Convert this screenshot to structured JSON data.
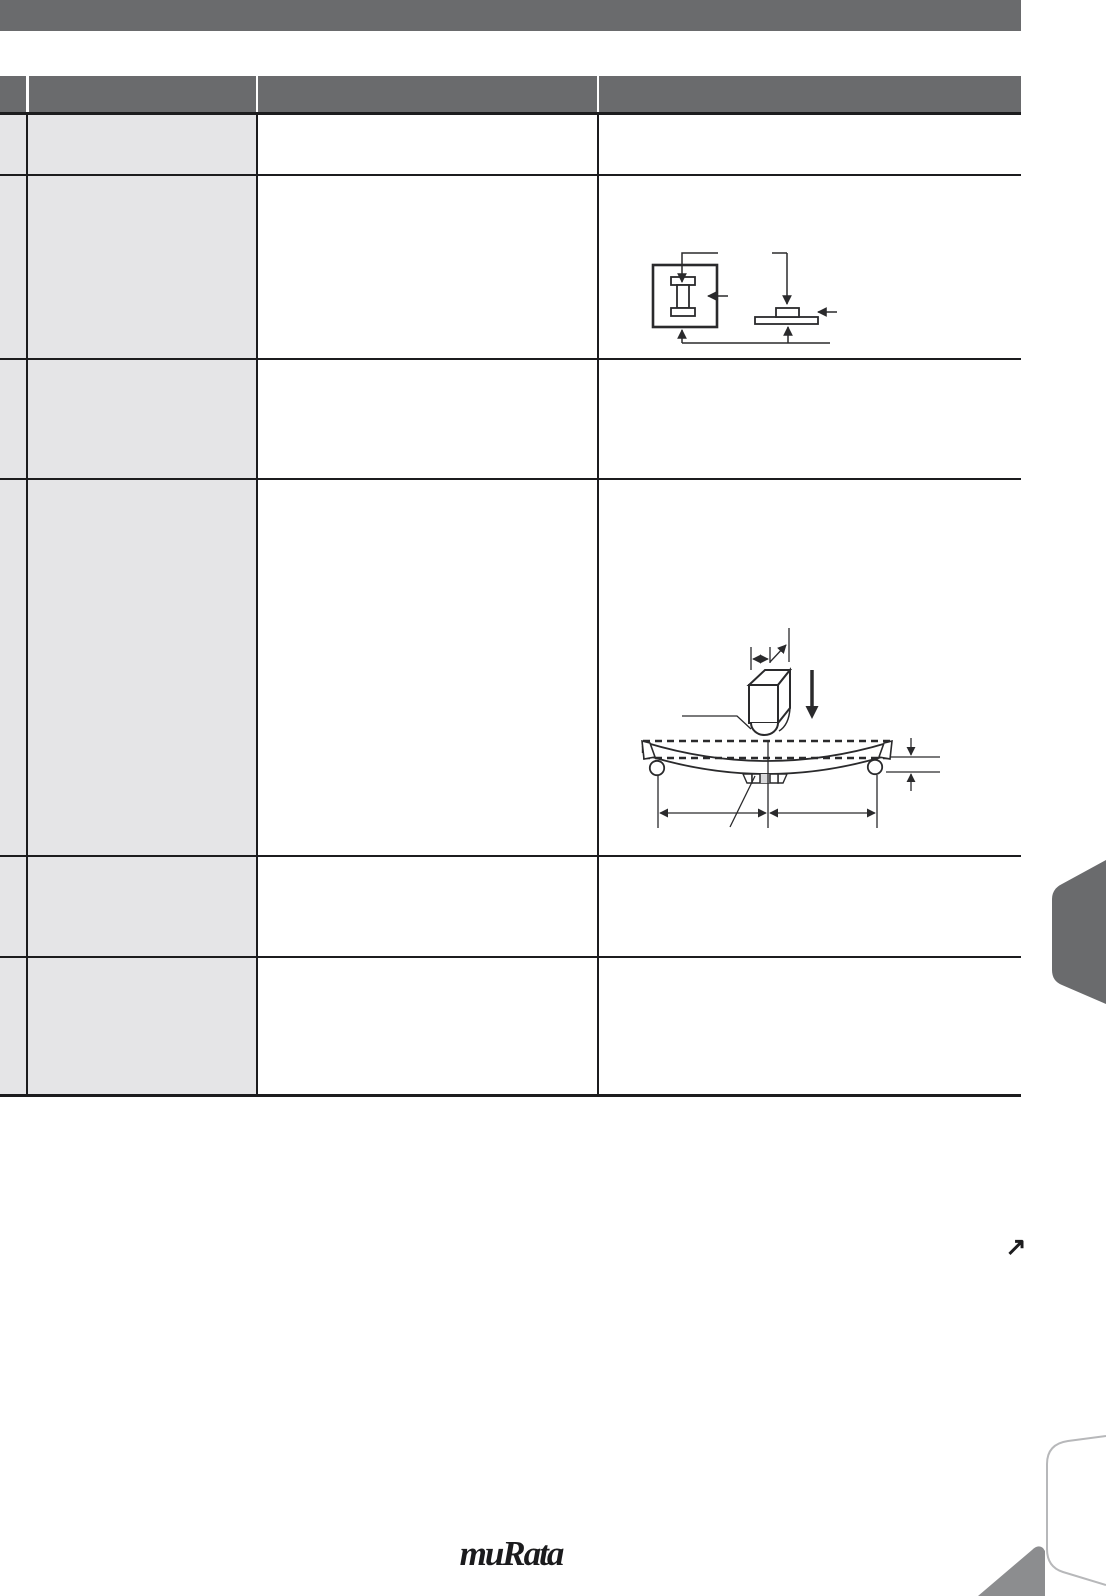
{
  "footer": {
    "logo_text": "muRata"
  },
  "icons": {
    "continue_arrow": "↗"
  },
  "colors": {
    "page_bg": "#ffffff",
    "banner": "#6a6b6d",
    "row_label_bg": "#e5e5e7",
    "grid_line": "#1c1c1e",
    "diagram_line": "#2a2a2c",
    "side_tab": "#6a6b6d",
    "corner_accent": "#8c8d8f",
    "card_outline": "#b7b8ba",
    "chip_fill": "#d9d9db"
  }
}
